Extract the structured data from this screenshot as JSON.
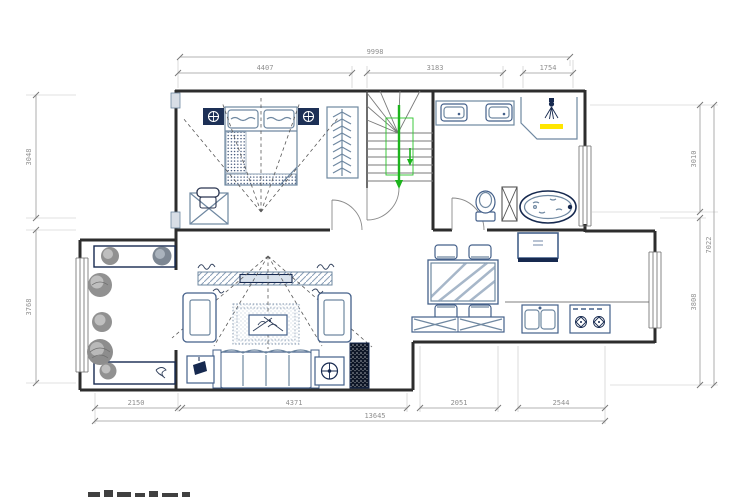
{
  "drawing": {
    "title": "floor-plan",
    "type": "architectural-cad-floor-plan",
    "dimensions": {
      "top": {
        "overall": "9998",
        "segments": [
          "4407",
          "3183",
          "1754"
        ]
      },
      "bottom": {
        "overall": "13645",
        "segments": [
          "2150",
          "4371",
          "2051",
          "2544"
        ]
      },
      "left": {
        "segments": [
          "3048",
          "3768"
        ]
      },
      "right": {
        "overall": "7022",
        "segments": [
          "3010",
          "3808"
        ]
      }
    },
    "colors": {
      "walls": "#2d2d2d",
      "furniture_line": "#6f88a1",
      "furniture_dark": "#44608a",
      "accent_navy": "#16294f",
      "stairs_arrow_green": "#1db41d",
      "shower_highlight_yellow": "#ffe600",
      "plant_gray": "#919191",
      "dimension_gray": "#8f8f8f"
    },
    "icons": {
      "stairs_direction": "down-arrow",
      "bedside_lamp": "circle-cross",
      "floor_lamp": "circle-cross",
      "shower": "shower-head",
      "stove_burner": "burner-diamond"
    }
  }
}
